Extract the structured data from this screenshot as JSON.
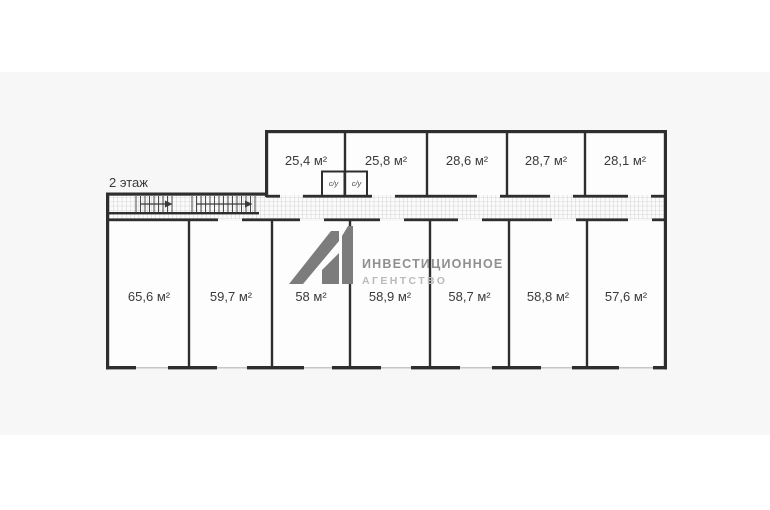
{
  "floor_label": "2 этаж",
  "rooms_top": [
    "25,4 м²",
    "25,8 м²",
    "28,6 м²",
    "28,7 м²",
    "28,1 м²"
  ],
  "rooms_bottom": [
    "65,6 м²",
    "59,7 м²",
    "58 м²",
    "58,9 м²",
    "58,7 м²",
    "58,8 м²",
    "57,6 м²"
  ],
  "wc_rooms": [
    "с/у",
    "с/у"
  ],
  "watermark": {
    "logo": "A1",
    "line1": "ИНВЕСТИЦИОННОЕ",
    "line2": "АГЕНТСТВО"
  },
  "colors": {
    "wall": "#2e2e2e",
    "text": "#3a3a3a",
    "page_bg": "#ffffff",
    "band_bg": "#f7f7f8",
    "room_fill": "#fdfdfd",
    "hatch_line": "#c9c9c9",
    "watermark_logo": "#7c7c7c",
    "watermark_text": "#8f8f8f",
    "watermark_text_light": "#b9babc"
  }
}
